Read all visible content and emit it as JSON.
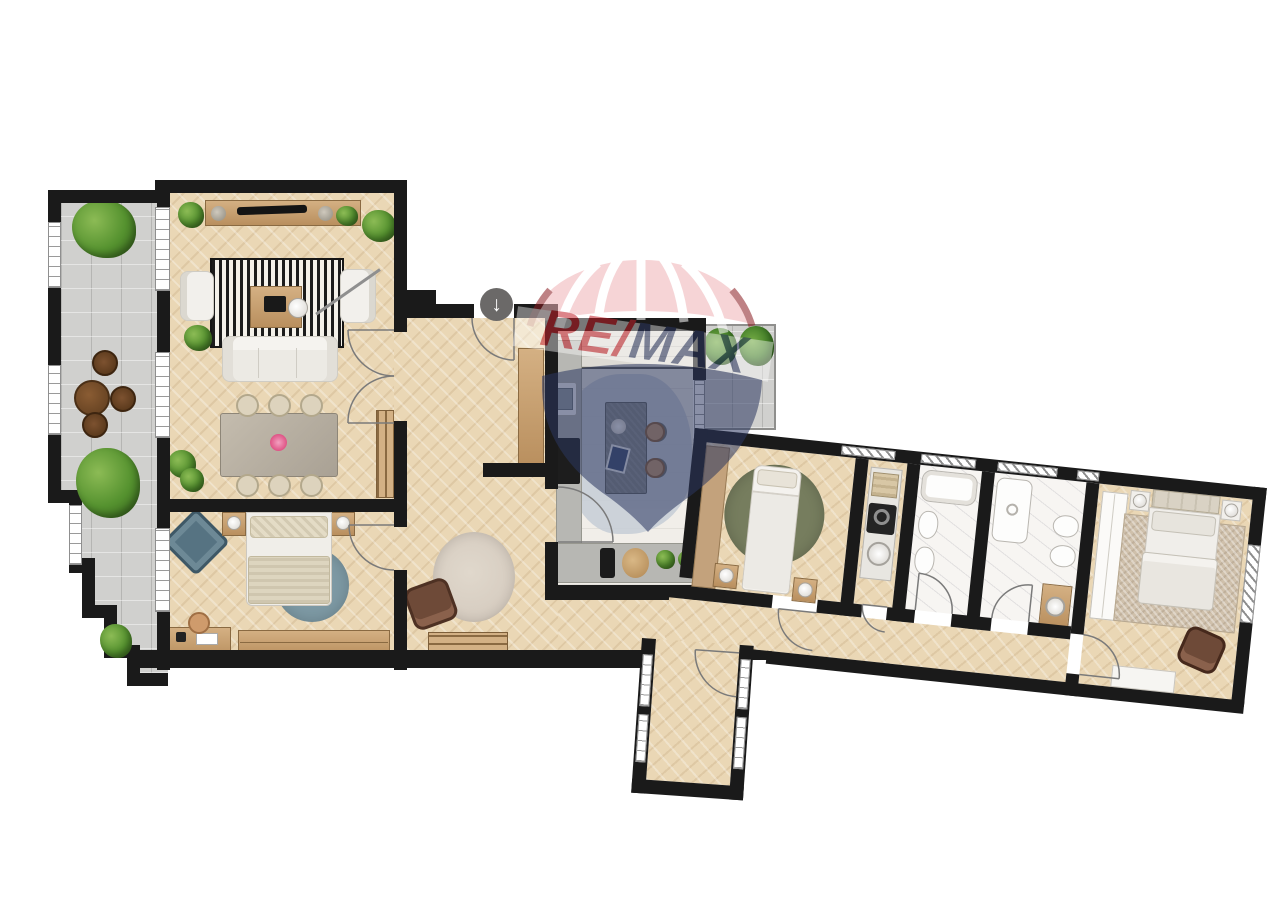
{
  "watermark": {
    "brand": "RE/MAX",
    "text_re": "RE",
    "text_slash": "/",
    "text_max": "MAX",
    "color_red": "#C2202A",
    "color_navy": "#2B3760",
    "color_pink": "#F0B2B6",
    "color_dark_red": "#8A1B20",
    "opacity": "0.55"
  },
  "entrance_marker": {
    "icon": "down-arrow-icon",
    "glyph": "↓"
  },
  "palette": {
    "wall": "#1A1A1A",
    "wood_floor": "#EAD7B5",
    "terrace_stone": "#D0D0CE",
    "kitchen_floor": "#F1EEE9",
    "marble": "#F7F5F2",
    "counter_grey": "#B7B7B3",
    "island_grey": "#878A8A",
    "sofa_white": "#F2F0EC",
    "plant_green": "#55922F",
    "armchair_brown": "#6E4A38",
    "armchair_blue": "#567382",
    "rug_blue": "#7D99A4",
    "rug_olive": "#767D5E",
    "rug_hall": "#D6CCC0",
    "rug_master": "#CFC0AB",
    "kitchen_rug": "#C6CDD6",
    "rug_stripe_dark": "#1C1C1C"
  }
}
